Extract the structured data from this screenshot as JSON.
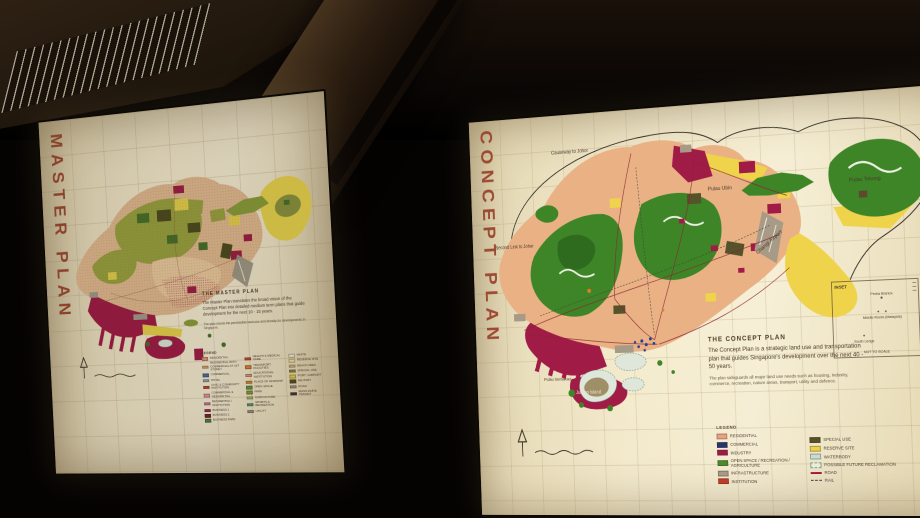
{
  "palette": {
    "panel_bg": "#f2e8ca",
    "title_text": "#9c4a33",
    "map_green": "#3e8527",
    "map_olive": "#9aa540",
    "map_crimson": "#a01c46",
    "map_yellow": "#eed34b",
    "map_salmon": "#e9b184",
    "map_gray": "#a79a86",
    "map_dark_olive": "#56522a",
    "ink": "#4a3a2c"
  },
  "left_panel": {
    "title": "MASTER PLAN",
    "info": {
      "heading": "THE MASTER PLAN",
      "body": "The Master Plan translates the broad vision of the Concept Plan into detailed medium term plans that guide development for the next 10 - 15 years.",
      "note": "The plan shows the permissible land use and density for developments in Singapore."
    },
    "legend": {
      "heading": "LEGEND",
      "col1": [
        {
          "label": "RESIDENTIAL",
          "color": "#e09a84"
        },
        {
          "label": "RESIDENTIAL WITH COMMERCIAL AT 1ST STOREY",
          "color": "#e5ad6c"
        },
        {
          "label": "COMMERCIAL",
          "color": "#4f6cab"
        },
        {
          "label": "HOTEL",
          "color": "#9badbc"
        },
        {
          "label": "CIVIC & COMMUNITY INSTITUTION",
          "color": "#c1492f"
        },
        {
          "label": "COMMERCIAL & RESIDENTIAL",
          "color": "#e39aa6"
        },
        {
          "label": "RESIDENTIAL / INSTITUTION",
          "color": "#d37f95"
        },
        {
          "label": "BUSINESS 1",
          "color": "#a42952"
        },
        {
          "label": "BUSINESS 2",
          "color": "#7c2038"
        },
        {
          "label": "BUSINESS PARK",
          "color": "#4c8838"
        }
      ],
      "col2": [
        {
          "label": "HEALTH & MEDICAL CARE",
          "color": "#c84f34"
        },
        {
          "label": "TRANSPORT FACILITIES",
          "color": "#dd813e"
        },
        {
          "label": "EDUCATIONAL INSTITUTION",
          "color": "#e29b76"
        },
        {
          "label": "PLACE OF WORSHIP",
          "color": "#da8e3b"
        },
        {
          "label": "OPEN SPACE",
          "color": "#5d9b41"
        },
        {
          "label": "PARK",
          "color": "#8a9a3a"
        },
        {
          "label": "AGRICULTURE",
          "color": "#a6c77b"
        },
        {
          "label": "SPORTS & RECREATION",
          "color": "#55a080"
        },
        {
          "label": "UTILITY",
          "color": "#99998b"
        }
      ],
      "col3": [
        {
          "label": "WHITE",
          "color": "#f4eed9"
        },
        {
          "label": "RESERVE SITE",
          "color": "#eee3a8"
        },
        {
          "label": "BEACH AREA",
          "color": "#d7c190"
        },
        {
          "label": "SPECIAL USE",
          "color": "#8e8e44"
        },
        {
          "label": "PORT / AIRPORT",
          "color": "#e5d14e"
        },
        {
          "label": "MILITARY",
          "color": "#565226"
        },
        {
          "label": "ROAD",
          "color": "#a29c8f"
        },
        {
          "label": "MASS RAPID TRANSIT",
          "color": "#43354a"
        }
      ]
    }
  },
  "right_panel": {
    "title": "CONCEPT PLAN",
    "info": {
      "heading": "THE CONCEPT PLAN",
      "body": "The Concept Plan is a strategic land use and transportation plan that guides Singapore's development over the next 40 - 50 years.",
      "note": "The plan safeguards all major land use needs such as housing, industry, commerce, recreation, nature areas, transport, utility and defence."
    },
    "map_labels": {
      "causeway": "Causeway to Johor",
      "second_link": "Second Link to Johor",
      "pulau_ubin": "Pulau Ubin",
      "pulau_tekong": "Pulau Tekong",
      "changi_airport": "Changi Airport",
      "jurong_island": "Jurong Island",
      "pulau_semakau": "Pulau Semakau"
    },
    "inset": {
      "title": "INSET",
      "island1": "Pedra Branca",
      "island2": "Middle Rocks (Malaysia)",
      "island3": "South Ledge",
      "footer": "NOT TO SCALE"
    },
    "legend": {
      "heading": "LEGEND",
      "left": [
        {
          "label": "RESIDENTIAL",
          "color": "#e8a184"
        },
        {
          "label": "COMMERCIAL",
          "color": "#24366e"
        },
        {
          "label": "INDUSTRY",
          "color": "#9e1a4d"
        },
        {
          "label": "OPEN SPACE / RECREATION / AGRICULTURE",
          "color": "#4b8b2f"
        },
        {
          "label": "INFRASTRUCTURE",
          "color": "#a79a86"
        },
        {
          "label": "INSTITUTION",
          "color": "#c23b2a"
        }
      ],
      "right": [
        {
          "label": "SPECIAL USE",
          "color": "#57512a"
        },
        {
          "label": "RESERVE SITE",
          "color": "#ecd04d"
        },
        {
          "label": "WATERBODY",
          "color": "#ccdad3",
          "style": "thin-border"
        },
        {
          "label": "POSSIBLE FUTURE RECLAMATION",
          "color": "#e9ecdb",
          "style": "dashed-box"
        },
        {
          "label": "ROAD",
          "color": "#9b1f34",
          "style": "line"
        },
        {
          "label": "RAIL",
          "color": "#3a3a3a",
          "style": "dashed-line"
        }
      ]
    }
  }
}
